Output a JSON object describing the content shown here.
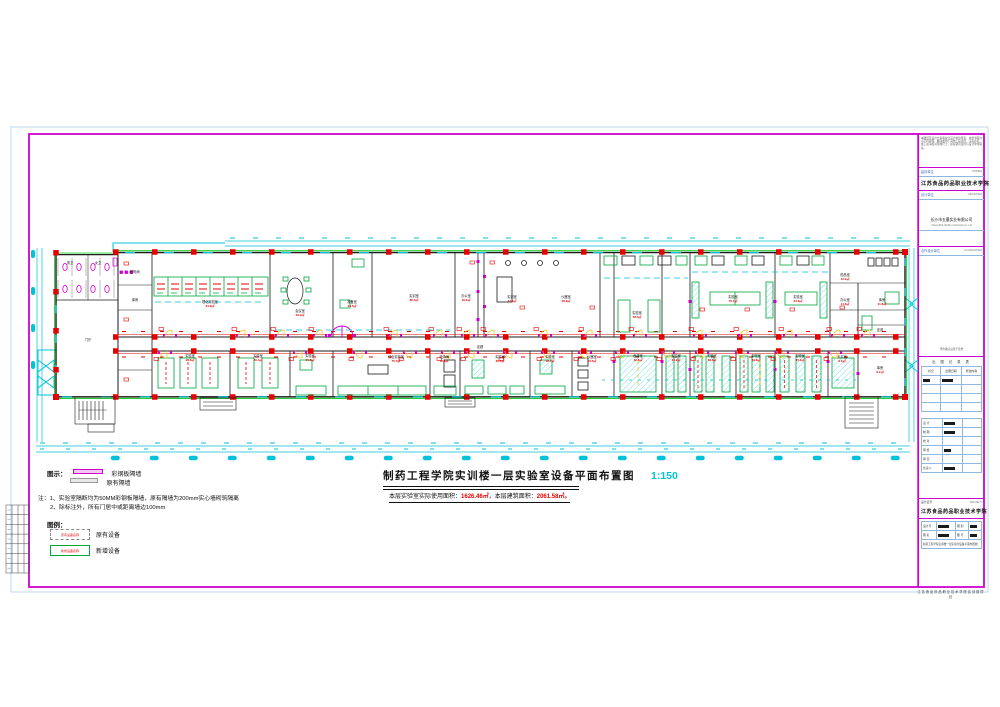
{
  "colors": {
    "red": "#e60000",
    "green": "#00a63c",
    "wall_green": "#00c814",
    "cyan": "#00c3d9",
    "magenta": "#cf00cf",
    "yellow": "#e6c619"
  },
  "drawing": {
    "title": "制药工程学院实训楼一层实验室设备平面布置图",
    "scale": "1:150",
    "area_prefix": "本层实验室实际使用面积：",
    "area_used": "1626.46㎡",
    "area_mid": "，本层建筑面积：",
    "area_total": "2061.58㎡",
    "area_end": "。"
  },
  "legend_lines": {
    "heading": "图示：",
    "items": [
      {
        "label": "彩钢板隔墙"
      },
      {
        "label": "原有隔墙"
      }
    ]
  },
  "notes": {
    "line1": "注：1、实验室隔断均为50MM彩钢板隔墙，原有隔墙为200mm实心墙砌筑隔离",
    "line2": "2、除标注外，所有门居中或距离墙边100mm"
  },
  "legend_boxes": {
    "heading": "图例：",
    "existing_label": "原有设备",
    "new_label": "新增设备",
    "existing_tag": "原有设备名称",
    "new_tag": "新增设备名称"
  },
  "title_block": {
    "disclaimer": "本图纸及设计方案版权归设计单位所有，未经书面许可不得复制、翻印或用于其他工程项目，违者必究。施工前请核对现场尺寸，如有疑问及时与设计单位联系。",
    "owner_label": "建设单位",
    "owner_en": "OWNER",
    "owner_name": "江苏食品药品职业技术学院",
    "designer_label": "设计单位",
    "designer_en": "DESIGNER",
    "designer_name": "长沙市五墨实业有限公司",
    "designer_name_en": "ChangSha WuMo Industrial Co.,Ltd",
    "co_label": "合作设计单位",
    "co_en": "CO.DESIGNER",
    "stamp_note": "甲方确认后签字盖章",
    "record_title": "出 图 记 录 表",
    "record_cols": [
      "标记",
      "出图日期",
      "修改内容"
    ],
    "sign_rows": [
      "设 计",
      "制 图",
      "校 对",
      "审 核",
      "审 定",
      "负责人"
    ],
    "project_cert_label": "设计证号",
    "project_en": "PROJECT",
    "project_name": "江苏食品药品职业技术学院",
    "f_design_no": "设计号",
    "f_type": "图 别",
    "f_name": "图 名",
    "f_no": "图 号",
    "sheet_title": "制药工程学院实训楼一层实验室设备平面布置图",
    "footer": "江苏食品药品职业技术学院实训楼项目"
  },
  "plan": {
    "rooms": [
      {
        "x": 70,
        "y": 264,
        "n": "男卫"
      },
      {
        "x": 98,
        "y": 264,
        "n": "女卫"
      },
      {
        "x": 88,
        "y": 341,
        "n": "门厅"
      },
      {
        "x": 135,
        "y": 273,
        "n": "配电间"
      },
      {
        "x": 135,
        "y": 301,
        "n": "库房"
      },
      {
        "x": 210,
        "y": 303,
        "n": "理化实验室",
        "a": "64.8㎡"
      },
      {
        "x": 300,
        "y": 312,
        "n": "会议室",
        "a": "46.2㎡"
      },
      {
        "x": 352,
        "y": 303,
        "n": "准备室",
        "a": "23.5㎡"
      },
      {
        "x": 414,
        "y": 297,
        "n": "实训室",
        "a": "86.4㎡"
      },
      {
        "x": 466,
        "y": 297,
        "n": "办公室",
        "a": "18.2㎡"
      },
      {
        "x": 512,
        "y": 298,
        "n": "实训室",
        "a": "47.4㎡"
      },
      {
        "x": 566,
        "y": 298,
        "n": "仪器室",
        "a": "28.9㎡"
      },
      {
        "x": 637,
        "y": 314,
        "n": "实验室",
        "a": "58.3㎡"
      },
      {
        "x": 733,
        "y": 298,
        "n": "实验室",
        "a": "76.1㎡"
      },
      {
        "x": 798,
        "y": 298,
        "n": "实验室",
        "a": "64.9㎡"
      },
      {
        "x": 845,
        "y": 276,
        "n": "药品室",
        "a": "12.2㎡"
      },
      {
        "x": 845,
        "y": 301,
        "n": "办公室",
        "a": "14.6㎡"
      },
      {
        "x": 882,
        "y": 301,
        "n": "库房",
        "a": "11.8㎡"
      },
      {
        "x": 880,
        "y": 331,
        "n": "走道"
      },
      {
        "x": 190,
        "y": 357,
        "n": "实验室",
        "a": "28.6㎡"
      },
      {
        "x": 258,
        "y": 357,
        "n": "实验室",
        "a": "30.4㎡"
      },
      {
        "x": 310,
        "y": 357,
        "n": "实验室",
        "a": "21.8㎡"
      },
      {
        "x": 396,
        "y": 358,
        "n": "综合实验室",
        "a": "75.4㎡"
      },
      {
        "x": 444,
        "y": 358,
        "n": "洗涤间",
        "a": "12.6㎡"
      },
      {
        "x": 500,
        "y": 358,
        "n": "实验室",
        "a": "36.4㎡"
      },
      {
        "x": 550,
        "y": 358,
        "n": "实验室",
        "a": "28.7㎡"
      },
      {
        "x": 592,
        "y": 358,
        "n": "仪器室",
        "a": "19.5㎡"
      },
      {
        "x": 638,
        "y": 357,
        "n": "色谱室",
        "a": "32.6㎡"
      },
      {
        "x": 676,
        "y": 357,
        "n": "实验室",
        "a": "30.2㎡"
      },
      {
        "x": 712,
        "y": 357,
        "n": "实验室",
        "a": "39.8㎡"
      },
      {
        "x": 756,
        "y": 357,
        "n": "实验室",
        "a": "39.8㎡"
      },
      {
        "x": 800,
        "y": 357,
        "n": "实验室",
        "a": "45.2㎡"
      },
      {
        "x": 842,
        "y": 358,
        "n": "天平室",
        "a": "9.6㎡"
      },
      {
        "x": 880,
        "y": 369,
        "n": "库房",
        "a": "8.2㎡"
      },
      {
        "x": 480,
        "y": 348,
        "n": "走廊"
      }
    ]
  }
}
